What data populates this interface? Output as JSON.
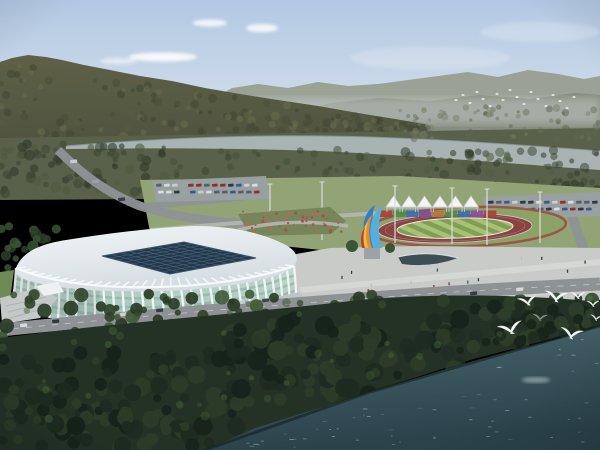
{
  "scene": {
    "type": "aerial-architectural-rendering",
    "subject": "white ribbed stadium and running-track sports park beside a river, forested mountains behind, lake with white birds in front",
    "palette": {
      "sky_top": "#b2c8e3",
      "sky_bottom": "#e3eaee",
      "cloud": "#ffffff",
      "far_range": "#9aa195",
      "far_range_near": "#848c7e",
      "mountain_base": "#50543f",
      "mountain_top": "#5e6147",
      "valley": "#5a614b",
      "river": "#a9b3b4",
      "river_edge": "#8c999b",
      "park_lawn": "#92a476",
      "park_path": "#b4b7b4",
      "parking": "#9aa0a3",
      "road": "#8e9295",
      "track_red": "#8a4340",
      "ring_red": "#9b4a42",
      "infield_a": "#a9c175",
      "infield_b": "#7f9f55",
      "lawn_green": "#8ca368",
      "plaza": "#c9cbc9",
      "plaza_light": "#d8dad7",
      "pond": "#3e4e55",
      "roof_a": "#f1f5f7",
      "roof_b": "#d5dde2",
      "skylight": "#24384a",
      "skylight_line": "#46627a",
      "glass_a": "#c4dbd1",
      "glass_b": "#9dc1b5",
      "rib": "#f4f6f6",
      "floor_band": "#86aa9e",
      "entrance": "#c4c8c8",
      "garden_green": "#76855a",
      "dark_trees": "#243226",
      "water_a": "#4a666e",
      "water_b": "#2b424b",
      "sparkle": "#a8c2c6",
      "shore": "#141f1a",
      "bird_white": "#f5f7f6",
      "bird_gray": "#7a8488",
      "tent_white": "#f3f5f5",
      "tent_edge": "#c9cdcf"
    },
    "clouds": [
      {
        "x": 163,
        "y": 57,
        "rx": 34,
        "ry": 4.5,
        "o": 0.85
      },
      {
        "x": 210,
        "y": 23,
        "rx": 17,
        "ry": 3.5,
        "o": 0.8
      },
      {
        "x": 262,
        "y": 28,
        "rx": 16,
        "ry": 4,
        "o": 0.8
      },
      {
        "x": 118,
        "y": 61,
        "rx": 18,
        "ry": 3,
        "o": 0.55
      },
      {
        "x": 540,
        "y": 32,
        "rx": 60,
        "ry": 10,
        "o": 0.22
      },
      {
        "x": 430,
        "y": 58,
        "rx": 80,
        "ry": 12,
        "o": 0.18
      }
    ],
    "flock_birds": [
      [
        456,
        100
      ],
      [
        463,
        95
      ],
      [
        470,
        103
      ],
      [
        477,
        92
      ],
      [
        483,
        99
      ],
      [
        490,
        106
      ],
      [
        497,
        94
      ],
      [
        503,
        100
      ],
      [
        510,
        90
      ],
      [
        517,
        97
      ],
      [
        524,
        104
      ],
      [
        531,
        92
      ],
      [
        538,
        99
      ],
      [
        546,
        106
      ],
      [
        553,
        95
      ],
      [
        560,
        101
      ],
      [
        567,
        108
      ],
      [
        574,
        97
      ]
    ],
    "large_birds": [
      {
        "x": 528,
        "y": 303,
        "s": 1.0,
        "r": -10,
        "gray": false
      },
      {
        "x": 556,
        "y": 299,
        "s": 1.2,
        "r": 6,
        "gray": false
      },
      {
        "x": 578,
        "y": 297,
        "s": 0.8,
        "r": 0,
        "gray": false
      },
      {
        "x": 540,
        "y": 319,
        "s": 0.7,
        "r": 4,
        "gray": true
      },
      {
        "x": 511,
        "y": 331,
        "s": 1.25,
        "r": -14,
        "gray": false
      },
      {
        "x": 571,
        "y": 336,
        "s": 1.15,
        "r": 10,
        "gray": false
      },
      {
        "x": 593,
        "y": 305,
        "s": 0.65,
        "r": 0,
        "gray": false
      },
      {
        "x": 596,
        "y": 319,
        "s": 0.6,
        "r": 8,
        "gray": false
      }
    ],
    "tents": {
      "count": 6,
      "x": 386,
      "dx": 15.5,
      "baseY": 207,
      "peakH": 11,
      "w": 15
    },
    "wall_colors": [
      "#a8423a",
      "#4f8c4c",
      "#3f6fad",
      "#7d4f9c",
      "#b0793f",
      "#4f8c4c",
      "#3f6fad",
      "#8e4f9e",
      "#a8423a"
    ],
    "sculpture_colors": {
      "blue": "#2f7ec7",
      "light_blue": "#56aedd",
      "orange": "#e68c2e",
      "yellow": "#e6c23a",
      "red": "#c23e2e",
      "pedestal": "#9ca2a6"
    },
    "car_colors": [
      "#d8dcdf",
      "#2e3844",
      "#9aa3ab",
      "#8f2f2a",
      "#3a5a8c",
      "#c9cdd1",
      "#57606a"
    ],
    "parking_lots": [
      {
        "x": 156,
        "y": 184,
        "rows": 2,
        "cols": 13,
        "dx": 8,
        "dy": 7
      },
      {
        "x": 488,
        "y": 201,
        "rows": 2,
        "cols": 14,
        "dx": 8,
        "dy": 7
      }
    ],
    "road_cars": [
      {
        "x": 20,
        "y": 324,
        "c": "#d8dcd8"
      },
      {
        "x": 52,
        "y": 320,
        "c": "#2e3640"
      },
      {
        "x": 120,
        "y": 313,
        "c": "#d0d4d8"
      },
      {
        "x": 156,
        "y": 309,
        "c": "#343c48"
      },
      {
        "x": 238,
        "y": 301,
        "c": "#c8ccd0"
      },
      {
        "x": 262,
        "y": 299,
        "c": "#3c444e"
      },
      {
        "x": 88,
        "y": 366,
        "c": "#a03028"
      },
      {
        "x": 44,
        "y": 371,
        "c": "#d8d8d8"
      },
      {
        "x": 18,
        "y": 376,
        "c": "#2e3640"
      },
      {
        "x": 305,
        "y": 312,
        "c": "#d4d8da",
        "w": 14,
        "h": 5
      },
      {
        "x": 470,
        "y": 292,
        "c": "#343c48"
      },
      {
        "x": 516,
        "y": 288,
        "c": "#d6dadc"
      },
      {
        "x": 70,
        "y": 160,
        "c": "#c8ccd0"
      },
      {
        "x": 92,
        "y": 180,
        "c": "#9aa0a8"
      },
      {
        "x": 118,
        "y": 198,
        "c": "#343c46"
      }
    ],
    "poles": [
      {
        "x": 270,
        "y1": 184,
        "y2": 230
      },
      {
        "x": 322,
        "y1": 182,
        "y2": 240
      },
      {
        "x": 395,
        "y1": 186,
        "y2": 243
      },
      {
        "x": 452,
        "y1": 188,
        "y2": 244
      },
      {
        "x": 487,
        "y1": 189,
        "y2": 245
      },
      {
        "x": 540,
        "y1": 192,
        "y2": 243
      }
    ],
    "people": {
      "count": 34,
      "colors": [
        "#2c3440",
        "#d8d8d8",
        "#823030",
        "#3c4c6c",
        "#c8b8a8",
        "#204030"
      ]
    },
    "stadium": {
      "rib_count": 33,
      "floor_bands": [
        0.28,
        0.5,
        0.72
      ],
      "skylight_grid": 9
    },
    "garden_dots": {
      "count": 55,
      "colors": [
        "#b24a44",
        "#c46650"
      ]
    },
    "sparkles": {
      "count": 60
    },
    "texture_zones": [
      {
        "name": "valley-right",
        "x": 400,
        "y": 106,
        "w": 200,
        "h": 34,
        "n": 70,
        "r0": 1.5,
        "r1": 4,
        "colors": [
          "#6b7258",
          "#7a8066",
          "#5c6350"
        ],
        "o": 0.5,
        "clipShore": false
      },
      {
        "name": "near-left",
        "x": 0,
        "y": 144,
        "w": 165,
        "h": 50,
        "n": 85,
        "r0": 2,
        "r1": 5.5,
        "colors": [
          "#3c4733",
          "#4c5a3e",
          "#2f3a29"
        ],
        "o": 0.6,
        "clipShore": false
      },
      {
        "name": "near-center",
        "x": 165,
        "y": 150,
        "w": 235,
        "h": 26,
        "n": 60,
        "r0": 2,
        "r1": 4.5,
        "colors": [
          "#43503a",
          "#55644a",
          "#38452f"
        ],
        "o": 0.55,
        "clipShore": false
      },
      {
        "name": "near-right",
        "x": 400,
        "y": 150,
        "w": 200,
        "h": 36,
        "n": 70,
        "r0": 2,
        "r1": 5,
        "colors": [
          "#3c4835",
          "#4e5e42",
          "#303c2a"
        ],
        "o": 0.55,
        "clipShore": false
      },
      {
        "name": "right-lower",
        "x": 540,
        "y": 182,
        "w": 60,
        "h": 26,
        "n": 24,
        "r0": 2,
        "r1": 5,
        "colors": [
          "#3c4835",
          "#2f3a29"
        ],
        "o": 0.6,
        "clipShore": false
      },
      {
        "name": "behind-stadium",
        "x": 0,
        "y": 224,
        "w": 58,
        "h": 46,
        "n": 22,
        "r0": 3,
        "r1": 6,
        "colors": [
          "#3a5434",
          "#2c4128"
        ],
        "o": 0.85,
        "clipShore": false
      },
      {
        "name": "plaza-top-row",
        "x": 432,
        "y": 240,
        "w": 140,
        "h": 14,
        "n": 16,
        "r0": 2.5,
        "r1": 4.5,
        "colors": [
          "#46603c",
          "#38502f"
        ],
        "o": 0.9,
        "clipShore": false
      },
      {
        "name": "roadside",
        "x": 0,
        "y": 294,
        "w": 380,
        "h": 56,
        "n": 85,
        "r0": 3,
        "r1": 7.5,
        "colors": [
          "#2f4229",
          "#3f5a35",
          "#273823"
        ],
        "o": 0.9,
        "clipShore": true
      },
      {
        "name": "dark-left",
        "x": 0,
        "y": 348,
        "w": 250,
        "h": 102,
        "n": 120,
        "r0": 4,
        "r1": 10,
        "colors": [
          "#1d2a1f",
          "#2c3c28",
          "#16231a"
        ],
        "o": 0.92,
        "clipShore": true
      },
      {
        "name": "dark-center",
        "x": 230,
        "y": 318,
        "w": 240,
        "h": 86,
        "n": 95,
        "r0": 4,
        "r1": 10,
        "colors": [
          "#1d2a1f",
          "#2c3c28",
          "#16231a"
        ],
        "o": 0.92,
        "clipShore": true
      },
      {
        "name": "dark-right",
        "x": 440,
        "y": 298,
        "w": 160,
        "h": 56,
        "n": 70,
        "r0": 3,
        "r1": 8,
        "colors": [
          "#1f2d22",
          "#2e3f2a",
          "#182419"
        ],
        "o": 0.92,
        "clipShore": true
      },
      {
        "name": "canopy-highlights",
        "x": 0,
        "y": 300,
        "w": 600,
        "h": 120,
        "n": 45,
        "r0": 2,
        "r1": 5,
        "colors": [
          "#3c5530",
          "#466336"
        ],
        "o": 0.5,
        "clipShore": true
      }
    ],
    "mountain_texture": {
      "n": 200,
      "colors": [
        "#3e4331",
        "#565b41",
        "#6a6e4b",
        "#474c37"
      ],
      "o": 0.5
    },
    "stadium_front_trees": [
      [
        78,
        332,
        8
      ],
      [
        108,
        338,
        9
      ],
      [
        142,
        344,
        8
      ],
      [
        206,
        340,
        7
      ],
      [
        252,
        332,
        8
      ],
      [
        296,
        318,
        8
      ],
      [
        322,
        308,
        7
      ]
    ],
    "plaza_trees": [
      [
        335,
        303
      ],
      [
        372,
        305
      ],
      [
        410,
        307
      ],
      [
        448,
        305
      ],
      [
        484,
        303
      ],
      [
        520,
        301
      ],
      [
        556,
        300
      ],
      [
        592,
        300
      ]
    ],
    "sculpture_side_trees": [
      [
        352,
        246,
        6
      ],
      [
        390,
        248,
        5
      ]
    ]
  }
}
